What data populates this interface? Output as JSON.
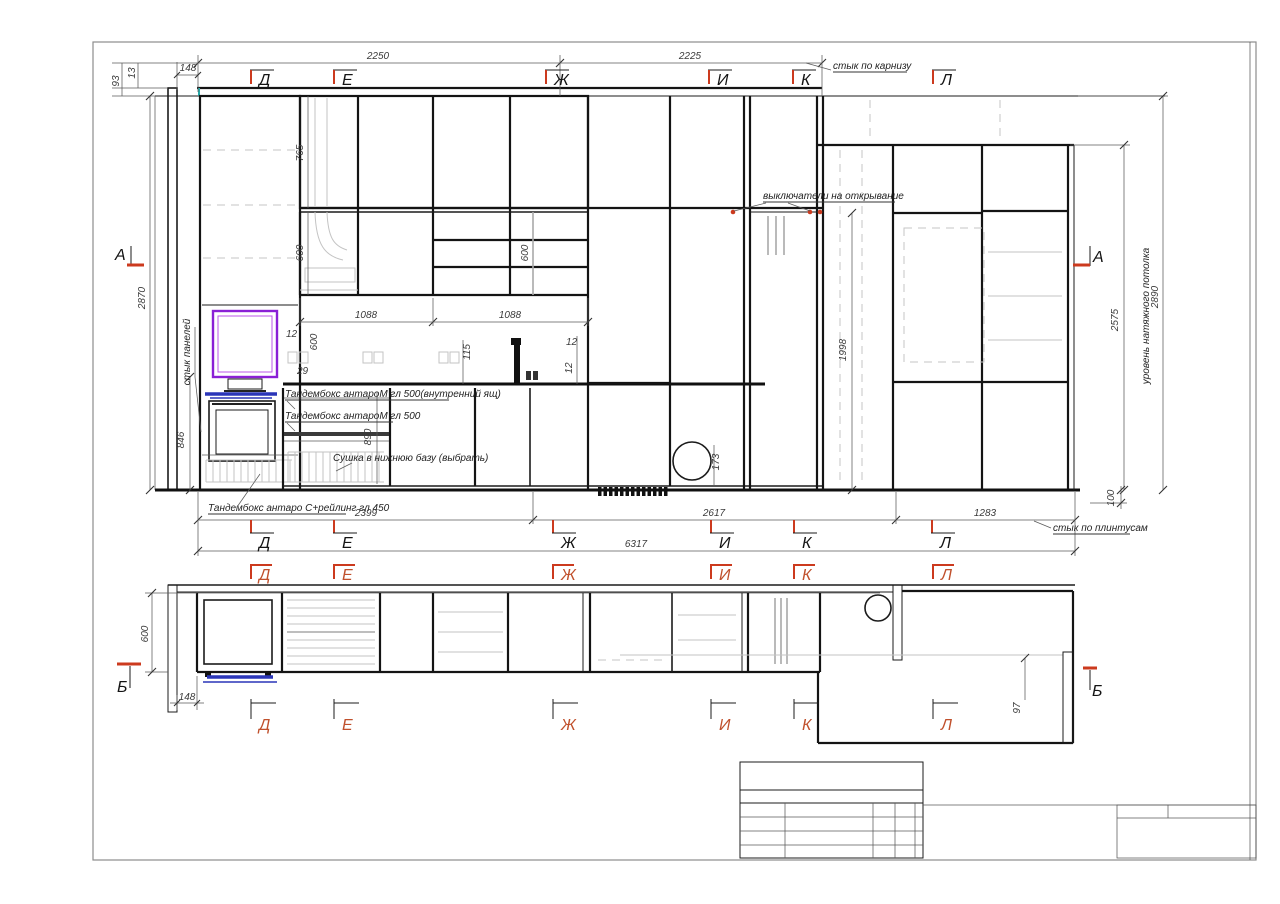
{
  "drawing": {
    "markers": {
      "letters": [
        "Д",
        "Е",
        "Ж",
        "И",
        "К",
        "Л"
      ],
      "section_a": "А",
      "section_b": "Б"
    },
    "dims": {
      "d93": "93",
      "d13": "13",
      "d148_top": "148",
      "d2250": "2250",
      "d2225": "2225",
      "d765": "765",
      "d600_hood": "600",
      "d600_shelf": "600",
      "d2870": "2870",
      "d1088_l": "1088",
      "d1088_r": "1088",
      "d12_l": "12",
      "d600_bs": "600",
      "d29": "29",
      "d115": "115",
      "d12_r1": "12",
      "d12_r2": "12",
      "d846": "846",
      "d890": "890",
      "d1998": "1998",
      "d173": "173",
      "d2575": "2575",
      "d2890": "2890",
      "d2399": "2399",
      "d2617": "2617",
      "d1283": "1283",
      "d100": "100",
      "d6317": "6317",
      "plan_600": "600",
      "plan_148": "148",
      "plan_97": "97"
    },
    "notes": {
      "cornice": "стык по карнизу",
      "panels": "стык панелей",
      "switches": "выключатели на открывание",
      "tandembox_inner": "Тандембокс антароМ гл 500(внутренний ящ)",
      "tandembox": "Тандембокс антароМ гл 500",
      "dryer": "Сушка в нижнюю базу (выбрать)",
      "tandembox_c": "Тандембокс антаро С+рейлинг гл 450",
      "plinth": "стык по плинтусам",
      "ceiling_level": "уровень натяжного потолка"
    }
  }
}
